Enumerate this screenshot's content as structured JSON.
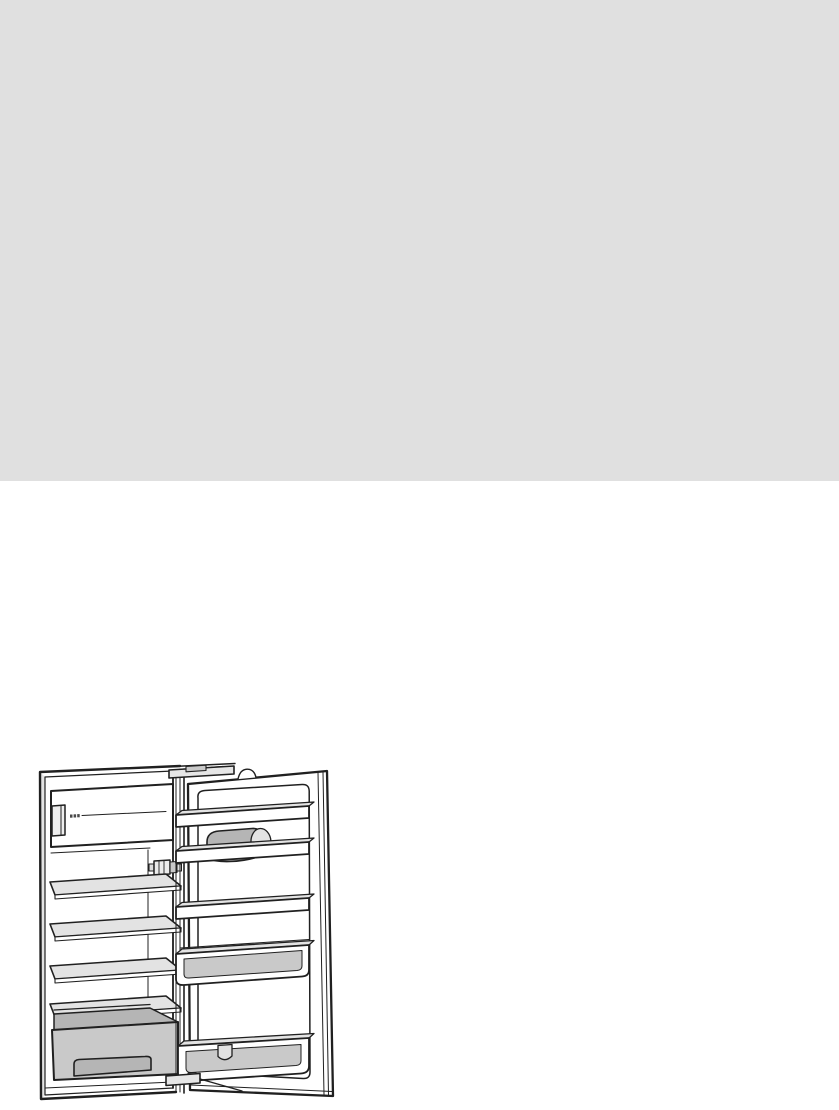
{
  "page": {
    "background_color": "#ffffff"
  },
  "header_block": {
    "name": "gray-placeholder-block",
    "color": "#e0e0e0"
  },
  "figure": {
    "name": "refrigerator-open-door-illustration",
    "description": "Black-and-white technical line drawing of a built-in refrigerator with its door open to the right: freezer compartment with flap and recessed grip at top, small badge marks on the flap, interior light bulb, four glass shelves, vegetable drawer with recessed handle at the bottom, and on the door two upper shelf rails with a shaded butter-compartment cover between them, a middle shelf rail, a deep storage bin, a bottom bin with divider clip, plus top and bottom hinges",
    "colors": {
      "line": "#202020",
      "paper": "#ffffff",
      "shade_light": "#e3e3e3",
      "shade_mid": "#c9c9c9",
      "shade_dark": "#b5b5b5",
      "badge": "#4a4a4a",
      "scribble": "#8f8f8f"
    },
    "parts": [
      {
        "name": "cabinet"
      },
      {
        "name": "freezer-compartment-flap"
      },
      {
        "name": "freezer-flap-grip"
      },
      {
        "name": "freezer-flap-badge"
      },
      {
        "name": "interior-light"
      },
      {
        "name": "glass-shelf-1"
      },
      {
        "name": "glass-shelf-2"
      },
      {
        "name": "glass-shelf-3"
      },
      {
        "name": "glass-shelf-4"
      },
      {
        "name": "vegetable-drawer"
      },
      {
        "name": "drawer-handle-recess"
      },
      {
        "name": "door"
      },
      {
        "name": "door-inner-panel"
      },
      {
        "name": "door-shelf-top"
      },
      {
        "name": "butter-compartment-cover"
      },
      {
        "name": "door-shelf-second"
      },
      {
        "name": "door-shelf-middle"
      },
      {
        "name": "door-bin-deep"
      },
      {
        "name": "door-bin-bottom"
      },
      {
        "name": "bin-divider-clip"
      },
      {
        "name": "top-hinge"
      },
      {
        "name": "bottom-hinge"
      }
    ]
  }
}
